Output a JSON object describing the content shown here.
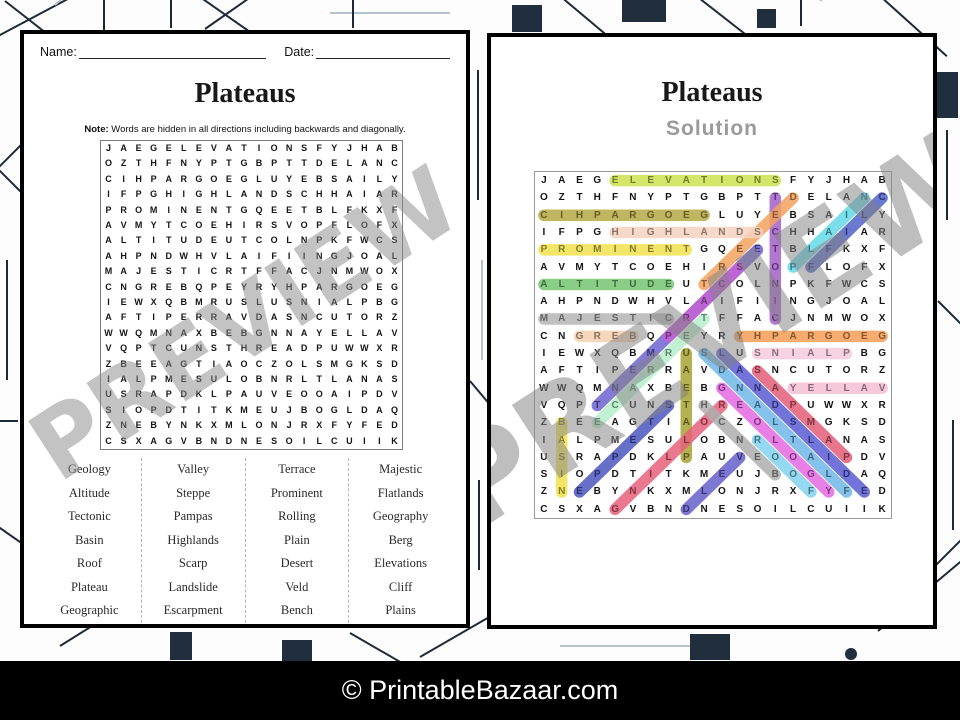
{
  "watermark": "PREVIEW",
  "footer": {
    "text": "© PrintableBazaar.com"
  },
  "puzzle_page": {
    "name_label": "Name:",
    "date_label": "Date:",
    "title": "Plateaus",
    "note_bold": "Note:",
    "note_rest": " Words are hidden in all directions including backwards and diagonally.",
    "grid": [
      "JAEGELEVATIONSFYJHAB",
      "OZTHFNYPTGBPTTDELANC",
      "CIHPARGOEGLUYEBSAILY",
      "IFPGHIGHLANDSCHHAIAR",
      "PROMINENTGQEETBLFKXF",
      "AVMYTCOEHIRSVOPFLOFX",
      "ALTITUDEUTCOLNPKFWCS",
      "AHPNDWHVLAIFIINGJOAL",
      "MAJESTICRTFFACJNMWOX",
      "CNGREBQPEYRYHPARGOEG",
      "IEWXQBMRUSLUSNIALPBG",
      "AFTIPERRAVDASNCUTORZ",
      "WWQMNAXBEBGNNAYELLAV",
      "VQPTCUNSTHREADPUWWXR",
      "ZBEEAGTIAOCZOLSMGKSD",
      "IALPMESULOBNRLTLANAS",
      "USRAPDKLPAUVEOOAIPDV",
      "SIOPDTITKMEUJBOGLDAQ",
      "ZNEBYNKXMLONJRXFYFED",
      "CSXAGVBNDNESOILCUIIK"
    ],
    "word_columns": [
      [
        "Geology",
        "Altitude",
        "Tectonic",
        "Basin",
        "Roof",
        "Plateau",
        "Geographic"
      ],
      [
        "Valley",
        "Steppe",
        "Pampas",
        "Highlands",
        "Scarp",
        "Landslide",
        "Escarpment"
      ],
      [
        "Terrace",
        "Prominent",
        "Rolling",
        "Plain",
        "Desert",
        "Veld",
        "Bench"
      ],
      [
        "Majestic",
        "Flatlands",
        "Geography",
        "Berg",
        "Elevations",
        "Cliff",
        "Plains"
      ]
    ]
  },
  "solution_page": {
    "title": "Plateaus",
    "subtitle": "Solution",
    "highlights": [
      {
        "word": "Elevations",
        "from": [
          1,
          5
        ],
        "to": [
          1,
          14
        ],
        "color": "#cde14f"
      },
      {
        "word": "Tectonic",
        "from": [
          2,
          14
        ],
        "to": [
          9,
          14
        ],
        "color": "#a55fc9"
      },
      {
        "word": "Desert",
        "from": [
          2,
          15
        ],
        "to": [
          7,
          10
        ],
        "color": "#f2a25f"
      },
      {
        "word": "Plain",
        "from": [
          6,
          15
        ],
        "to": [
          2,
          19
        ],
        "color": "#64d9e8"
      },
      {
        "word": "Cliff",
        "from": [
          2,
          20
        ],
        "to": [
          6,
          16
        ],
        "color": "#5063c8"
      },
      {
        "word": "Geographic",
        "from": [
          3,
          10
        ],
        "to": [
          3,
          1
        ],
        "color": "#b5a945"
      },
      {
        "word": "Highlands",
        "from": [
          4,
          5
        ],
        "to": [
          4,
          13
        ],
        "color": "#f6d2bf"
      },
      {
        "word": "Prominent",
        "from": [
          5,
          1
        ],
        "to": [
          5,
          9
        ],
        "color": "#f0e14d"
      },
      {
        "word": "Escarpment",
        "from": [
          5,
          13
        ],
        "to": [
          14,
          4
        ],
        "color": "#6f63d0"
      },
      {
        "word": "Scarp",
        "from": [
          6,
          12
        ],
        "to": [
          10,
          8
        ],
        "color": "#c562d3"
      },
      {
        "word": "Altitude",
        "from": [
          7,
          1
        ],
        "to": [
          7,
          8
        ],
        "color": "#74c471"
      },
      {
        "word": "Majestic",
        "from": [
          9,
          1
        ],
        "to": [
          9,
          8
        ],
        "color": "#b5b5b5"
      },
      {
        "word": "Terrace",
        "from": [
          9,
          10
        ],
        "to": [
          15,
          4
        ],
        "color": "#b6eecb"
      },
      {
        "word": "Geography",
        "from": [
          10,
          20
        ],
        "to": [
          10,
          12
        ],
        "color": "#f39e55"
      },
      {
        "word": "Berg",
        "from": [
          10,
          6
        ],
        "to": [
          10,
          3
        ],
        "color": "#f6d0af"
      },
      {
        "word": "Plateau",
        "from": [
          17,
          9
        ],
        "to": [
          11,
          9
        ],
        "color": "#a6a334"
      },
      {
        "word": "Plains",
        "from": [
          11,
          18
        ],
        "to": [
          11,
          13
        ],
        "color": "#f6cadd"
      },
      {
        "word": "Flatlands",
        "from": [
          19,
          18
        ],
        "to": [
          11,
          10
        ],
        "color": "#6fb7e9"
      },
      {
        "word": "Landslide",
        "from": [
          11,
          11
        ],
        "to": [
          19,
          19
        ],
        "color": "#5b5cd2"
      },
      {
        "word": "Geology",
        "from": [
          13,
          11
        ],
        "to": [
          19,
          17
        ],
        "color": "#e368e3"
      },
      {
        "word": "Valley",
        "from": [
          13,
          20
        ],
        "to": [
          13,
          15
        ],
        "color": "#f4bed4"
      },
      {
        "word": "Basin",
        "from": [
          15,
          2
        ],
        "to": [
          19,
          2
        ],
        "color": "#f1e14d"
      },
      {
        "word": "Steppe",
        "from": [
          14,
          8
        ],
        "to": [
          19,
          3
        ],
        "color": "#4c57bf"
      },
      {
        "word": "Rolling",
        "from": [
          14,
          11
        ],
        "to": [
          20,
          5
        ],
        "color": "#e6617c"
      },
      {
        "word": "Pampas",
        "from": [
          17,
          18
        ],
        "to": [
          12,
          13
        ],
        "color": "#e35d78"
      },
      {
        "word": "Bench",
        "from": [
          18,
          14
        ],
        "to": [
          14,
          10
        ],
        "color": "#aeaeae"
      },
      {
        "word": "Roof",
        "from": [
          16,
          13
        ],
        "to": [
          19,
          16
        ],
        "color": "#82d1ee"
      },
      {
        "word": "Veld",
        "from": [
          17,
          12
        ],
        "to": [
          20,
          9
        ],
        "color": "#665fcc"
      }
    ]
  }
}
